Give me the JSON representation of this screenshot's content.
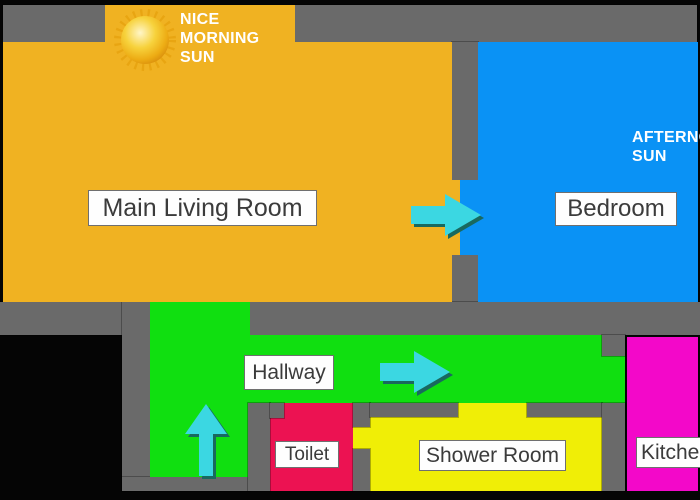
{
  "diagram": {
    "type": "apartment-floor-plan"
  },
  "rooms": {
    "living_room": {
      "label": "Main Living Room"
    },
    "bedroom": {
      "label": "Bedroom"
    },
    "hallway": {
      "label": "Hallway"
    },
    "toilet": {
      "label": "Toilet"
    },
    "shower_room": {
      "label": "Shower Room"
    },
    "kitchen": {
      "label": "Kitchen"
    }
  },
  "annotations": {
    "morning_sun": "NICE\nMORNING\nSUN",
    "afternoon_sun": "AFTERNOON\nSUN"
  },
  "arrows": [
    {
      "icon": "right-arrow-icon",
      "from": "living_room",
      "to": "bedroom"
    },
    {
      "icon": "right-arrow-icon",
      "along": "hallway"
    },
    {
      "icon": "up-arrow-icon",
      "along": "hallway"
    }
  ],
  "colors": {
    "background": "#050505",
    "wall": "#6A6A6A",
    "living_room": "#F0B222",
    "bedroom": "#0A92F5",
    "hallway": "#10DF10",
    "toilet": "#EC1252",
    "shower_room": "#F0EE06",
    "kitchen": "#F308C9",
    "arrow": "#3BD7E2",
    "arrow_shadow": "#19695F",
    "label_bg": "#FEFEFE",
    "label_border": "#6F6F6F",
    "label_text": "#3B3B3B",
    "annotation_text": "#FFFFFF",
    "sun": "#E8A512"
  }
}
